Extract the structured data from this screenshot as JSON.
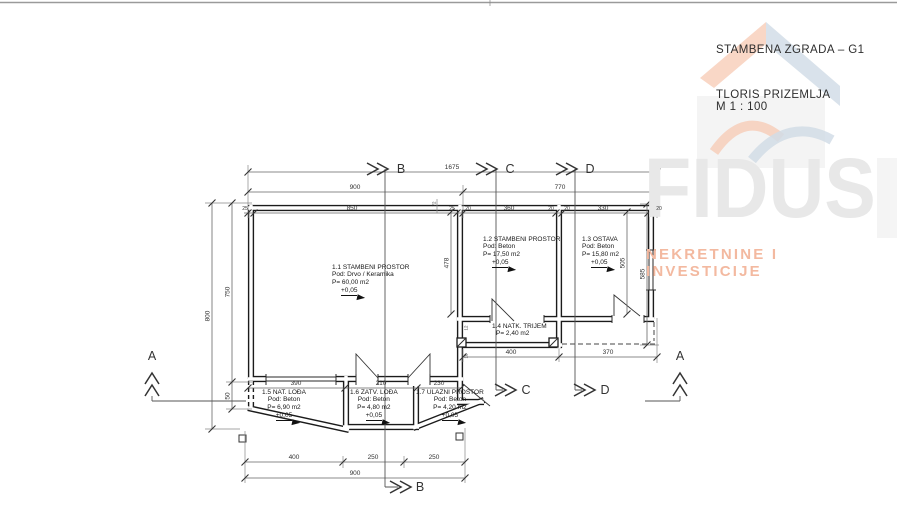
{
  "titleblock": {
    "project": "STAMBENA ZGRADA – G1",
    "drawing": "TLORIS PRIZEMLJA",
    "scale": "M 1 : 100"
  },
  "watermark": {
    "brand": "FIDUS",
    "tagline": "NEKRETNINE I INVESTICIJE",
    "brand_color": "#e8e8e8",
    "tagline_color": "#f3b9a0",
    "logo_orange": "#f0a37d",
    "logo_blue": "#aec1d2"
  },
  "sections": {
    "a": "A",
    "b": "B",
    "c": "C",
    "d": "D"
  },
  "rooms": {
    "r11": {
      "name": "1.1 STAMBENI PROSTOR",
      "floor": "Pod: Drvo / Keramika",
      "area": "P= 60,00 m2",
      "level": "+0,05"
    },
    "r12": {
      "name": "1.2 STAMBENI PROSTOR",
      "floor": "Pod: Beton",
      "area": "P= 17,50 m2",
      "level": "+0,05"
    },
    "r13": {
      "name": "1.3 OSTAVA",
      "floor": "Pod: Beton",
      "area": "P= 15,80 m2",
      "level": "+0,05"
    },
    "r14": {
      "name": "1.4 NATK. TRIJEM",
      "area": "P= 2,40 m2"
    },
    "r15": {
      "name": "1.5 NAT. LOĐA",
      "floor": "Pod: Beton",
      "area": "P= 6,90 m2",
      "level": "+0,05"
    },
    "r16": {
      "name": "1.6 ZATV. LOĐA",
      "floor": "Pod: Beton",
      "area": "P= 4,80 m2",
      "level": "+0,05"
    },
    "r17": {
      "name": "1.7 ULAZNI PROSTOR",
      "floor": "Pod: Beton",
      "area": "P= 4,20 m2",
      "level": "+0,05"
    }
  },
  "dims": {
    "overall_top": "1675",
    "span_main": "900",
    "span_wing": "770",
    "inner_main": "850",
    "inner_r12": "360",
    "inner_r13": "330",
    "height_total": "800",
    "height_main": "750",
    "height_plinth": "50",
    "height_wing": "585",
    "height_wing_inner": "505",
    "height_r12": "478",
    "wall_25": "25",
    "wall_20": "20",
    "wall_72": "72",
    "wall_12": "12",
    "wall_18": "18",
    "loggia_15": "390",
    "loggia_16": "210",
    "loggia_17": "230",
    "trijem_width": "400",
    "canopy_width": "370",
    "bottom_seg1": "400",
    "bottom_seg2": "250",
    "bottom_seg3": "250",
    "bottom_total": "900"
  }
}
